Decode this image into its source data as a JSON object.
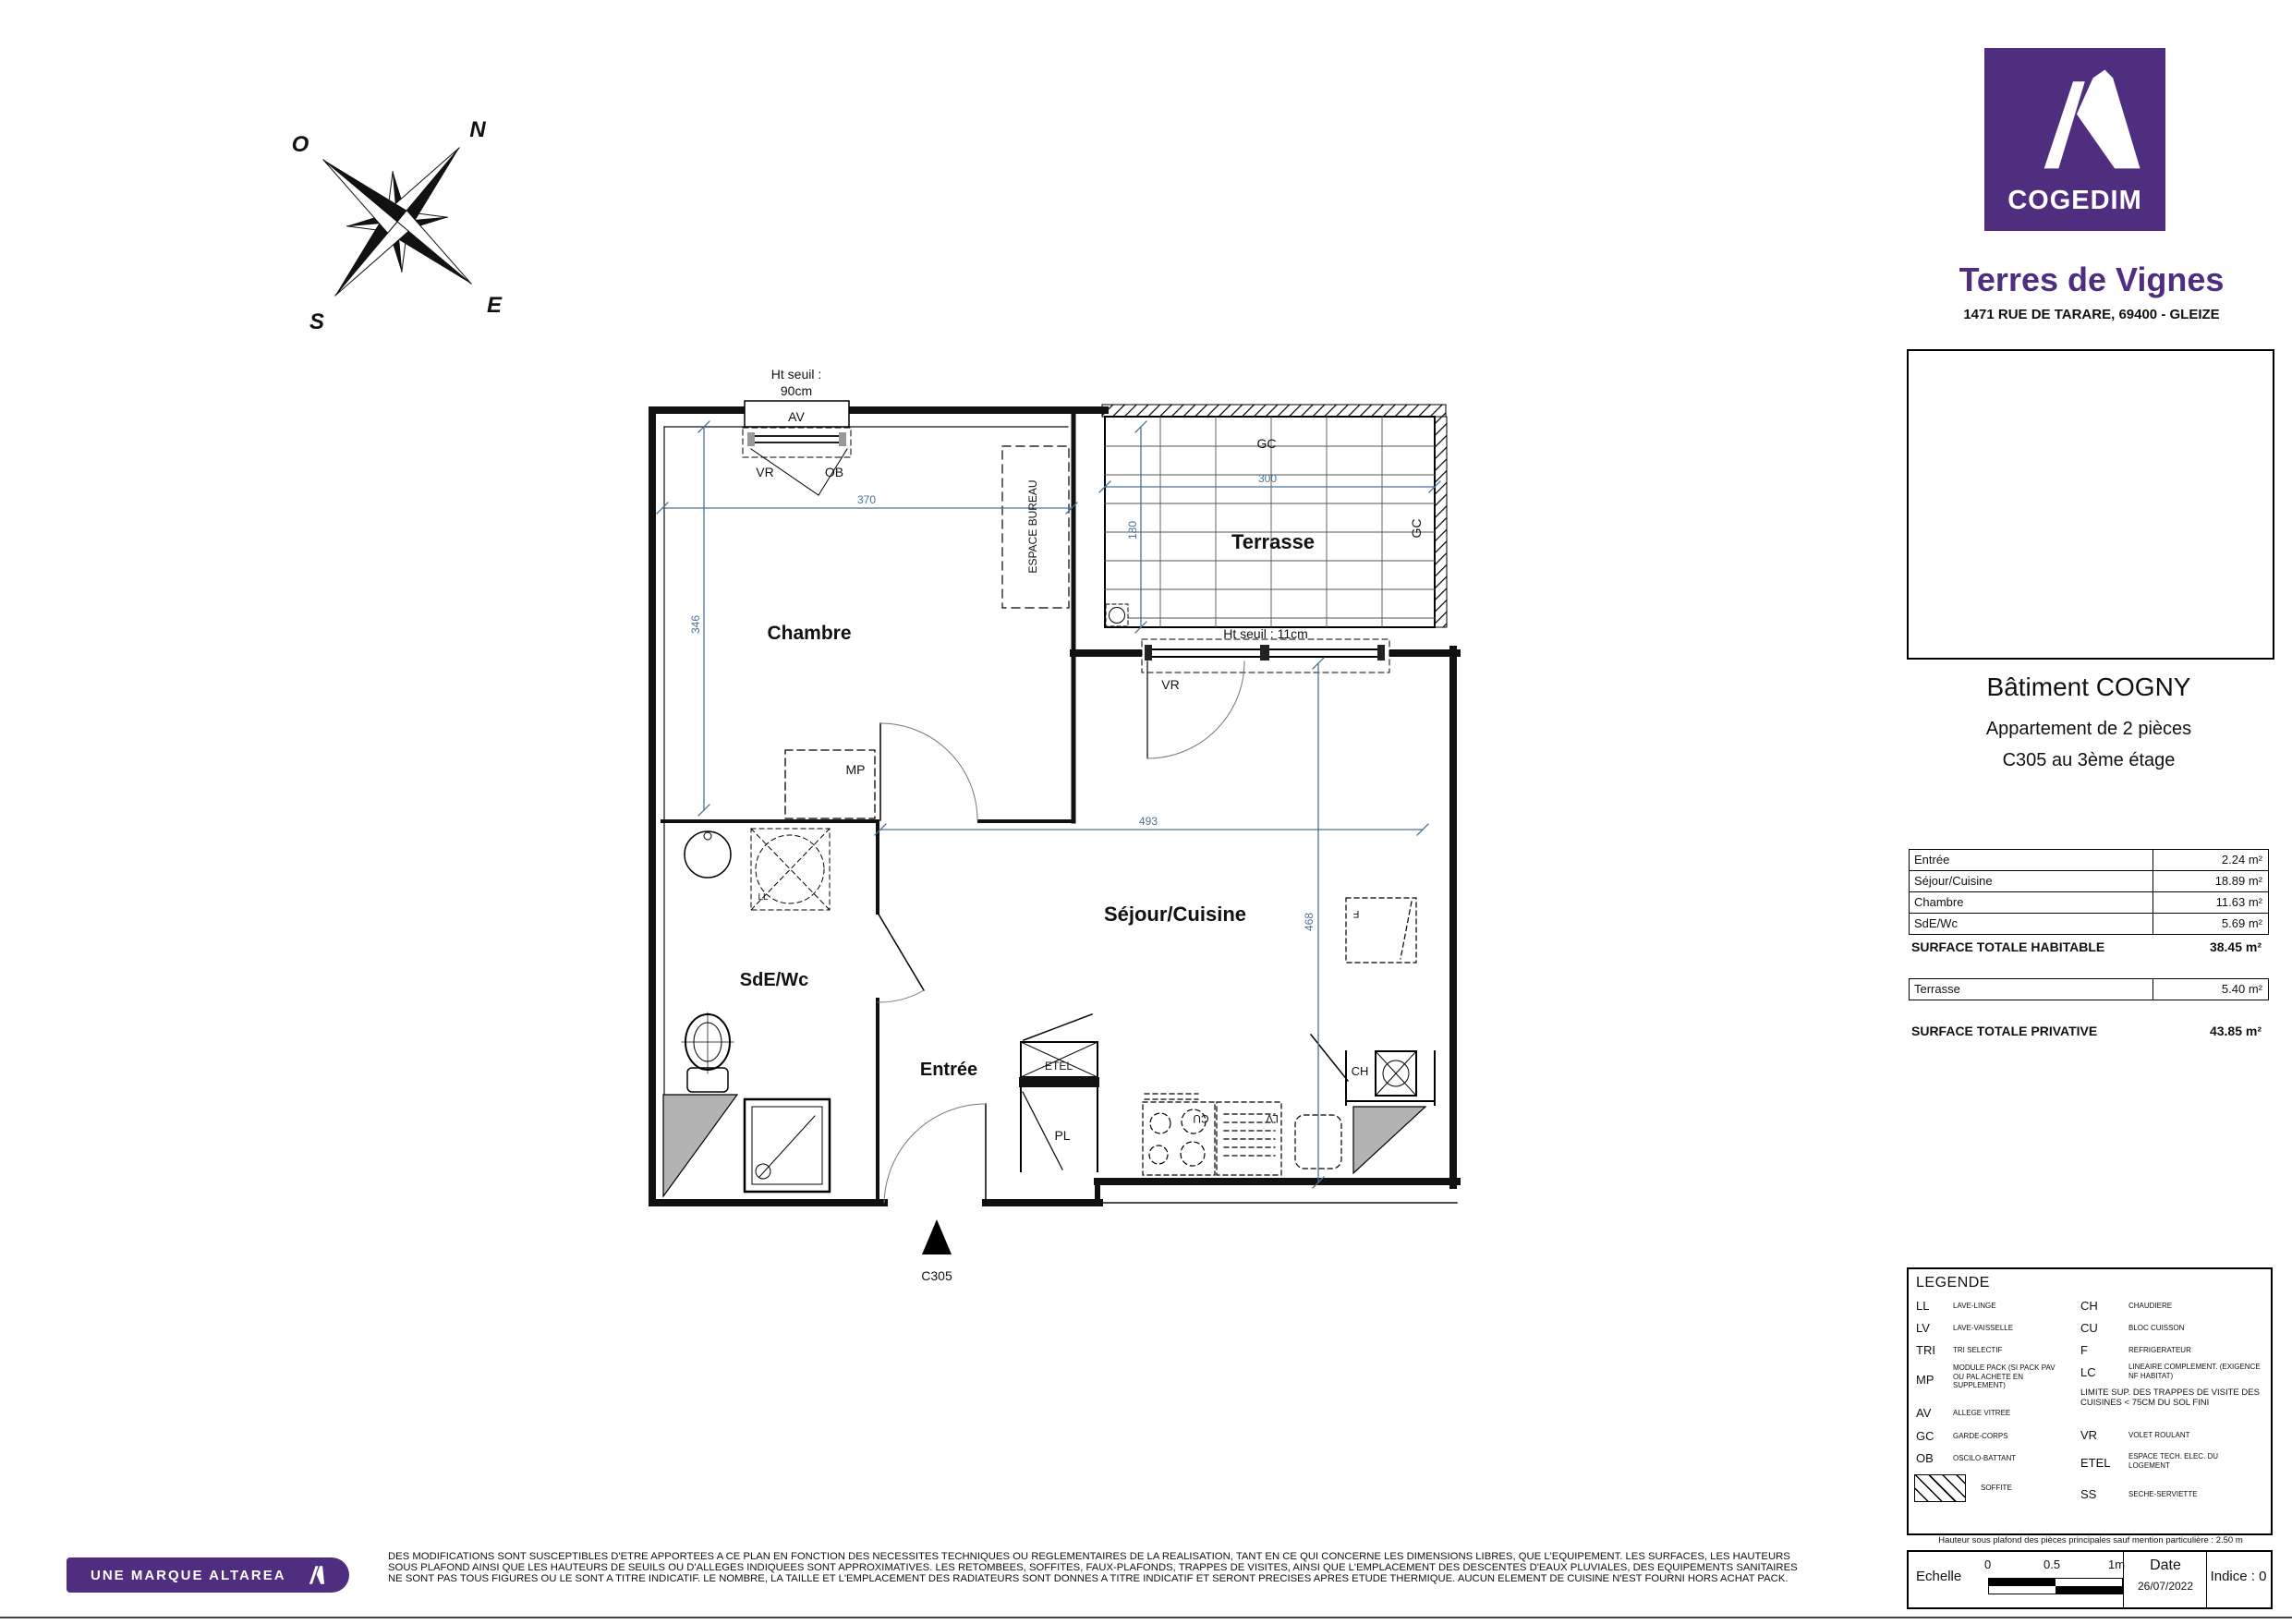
{
  "brand": {
    "logo_text": "COGEDIM",
    "project": "Terres de Vignes",
    "address": "1471 RUE DE TARARE, 69400 - GLEIZE",
    "banner": "UNE MARQUE ALTAREA",
    "purple": "#4F2D7F"
  },
  "building": {
    "title": "Bâtiment COGNY",
    "subtitle1": "Appartement de 2 pièces",
    "subtitle2": "C305 au 3ème étage"
  },
  "surfaces": {
    "rows": [
      {
        "label": "Entrée",
        "value": "2.24 m²"
      },
      {
        "label": "Séjour/Cuisine",
        "value": "18.89 m²"
      },
      {
        "label": "Chambre",
        "value": "11.63 m²"
      },
      {
        "label": "SdE/Wc",
        "value": "5.69 m²"
      }
    ],
    "total_habitable": {
      "label": "SURFACE TOTALE HABITABLE",
      "value": "38.45 m²"
    },
    "terrasse": {
      "label": "Terrasse",
      "value": "5.40 m²"
    },
    "total_privative": {
      "label": "SURFACE TOTALE PRIVATIVE",
      "value": "43.85 m²"
    }
  },
  "legend": {
    "title": "LEGENDE",
    "left": [
      {
        "abbr": "LL",
        "desc": "LAVE-LINGE"
      },
      {
        "abbr": "LV",
        "desc": "LAVE-VAISSELLE"
      },
      {
        "abbr": "TRI",
        "desc": "TRI SELECTIF"
      },
      {
        "abbr": "MP",
        "desc": "MODULE PACK (SI PACK PAV OU PAL ACHETE EN SUPPLEMENT)"
      },
      {
        "abbr": "AV",
        "desc": "ALLEGE VITREE"
      },
      {
        "abbr": "GC",
        "desc": "GARDE-CORPS"
      },
      {
        "abbr": "OB",
        "desc": "OSCILO-BATTANT"
      },
      {
        "abbr": "",
        "desc": "SOFFITE"
      }
    ],
    "right": [
      {
        "abbr": "CH",
        "desc": "CHAUDIERE"
      },
      {
        "abbr": "CU",
        "desc": "BLOC CUISSON"
      },
      {
        "abbr": "F",
        "desc": "REFRIGERATEUR"
      },
      {
        "abbr": "LC",
        "desc": "LINEAIRE COMPLEMENT. (EXIGENCE NF HABITAT)"
      },
      {
        "abbr": "VR",
        "desc": "VOLET ROULANT"
      },
      {
        "abbr": "ETEL",
        "desc": "ESPACE TECH. ELEC. DU LOGEMENT"
      },
      {
        "abbr": "SS",
        "desc": "SECHE-SERVIETTE"
      }
    ],
    "note": "LIMITE SUP. DES TRAPPES DE VISITE DES CUISINES < 75CM DU SOL FINI"
  },
  "notes": {
    "ceiling": "Hauteur sous plafond des pièces principales sauf mention particulière : 2.50 m",
    "disclaimer1": "DES MODIFICATIONS SONT SUSCEPTIBLES D'ETRE APPORTEES A CE PLAN EN FONCTION DES NECESSITES TECHNIQUES OU REGLEMENTAIRES DE LA REALISATION, TANT EN CE QUI CONCERNE LES DIMENSIONS LIBRES, QUE L'EQUIPEMENT. LES SURFACES, LES HAUTEURS",
    "disclaimer2": "SOUS PLAFOND AINSI QUE LES HAUTEURS DE SEUILS OU D'ALLEGES INDIQUEES SONT APPROXIMATIVES. LES RETOMBEES, SOFFITES, FAUX-PLAFONDS, TRAPPES DE VISITES, AINSI QUE L'EMPLACEMENT DES DESCENTES D'EAUX PLUVIALES, DES EQUIPEMENTS SANITAIRES",
    "disclaimer3": "NE SONT PAS TOUS FIGURES OU LE SONT A TITRE INDICATIF. LE NOMBRE, LA TAILLE ET L'EMPLACEMENT DES RADIATEURS SONT DONNES A TITRE INDICATIF ET SERONT PRECISES APRES ETUDE THERMIQUE. AUCUN ELEMENT DE CUISINE N'EST FOURNI HORS ACHAT PACK."
  },
  "footer": {
    "echelle_label": "Echelle",
    "tick0": "0",
    "tick05": "0.5",
    "tick1": "1m",
    "date_label": "Date",
    "date_value": "26/07/2022",
    "indice": "Indice : 0"
  },
  "plan": {
    "rooms": {
      "chambre": "Chambre",
      "terrasse": "Terrasse",
      "sejour": "Séjour/Cuisine",
      "sde": "SdE/Wc",
      "entree": "Entrée"
    },
    "dims": {
      "d370": "370",
      "d346": "346",
      "d300": "300",
      "d180": "180",
      "d493": "493",
      "d468": "468"
    },
    "annotations": {
      "ht_seuil_l1": "Ht seuil :",
      "ht_seuil_l2": "90cm",
      "ht_seuil_terrasse": "Ht seuil : 11cm",
      "av": "AV",
      "vr": "VR",
      "ob": "OB",
      "mp": "MP",
      "espace_bureau": "ESPACE BUREAU",
      "gc_top": "GC",
      "gc_right": "GC",
      "vr_terrasse": "VR",
      "etel": "ETEL",
      "pl": "PL",
      "ch": "CH",
      "cu": "CU",
      "lv": "LV",
      "ll": "LL",
      "f": "F",
      "unit": "C305"
    },
    "dim_color": "#4a7298"
  },
  "compass": {
    "n": "N",
    "e": "E",
    "s": "S",
    "o": "O"
  }
}
